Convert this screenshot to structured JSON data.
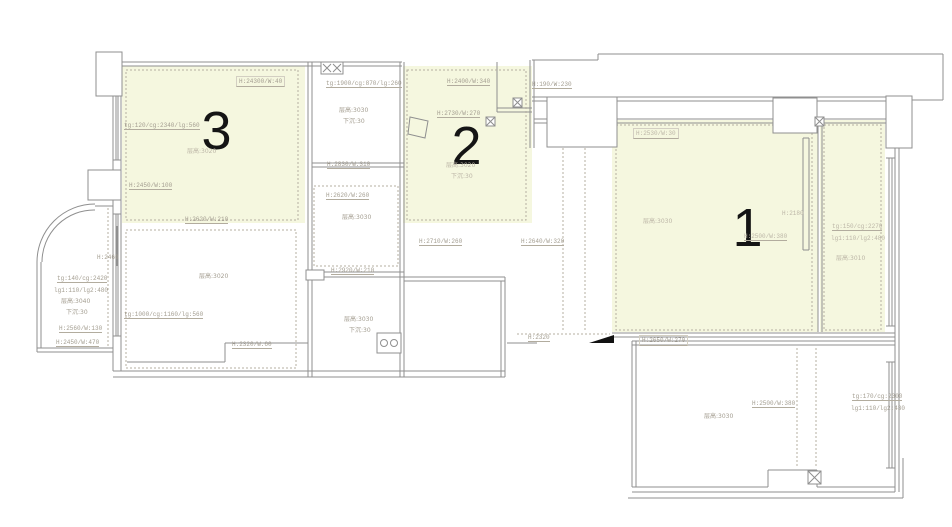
{
  "meta": {
    "type": "residential-floor-plan",
    "style": "cad-ceiling-plan"
  },
  "colors": {
    "highlight": "#f5f7df",
    "wall": "#8f8f8f",
    "annotation_text": "#a39d90",
    "room_digit": "#151515",
    "marker": "#111111"
  },
  "rooms": {
    "room1": {
      "digit": "1"
    },
    "room2": {
      "digit": "2"
    },
    "room3": {
      "digit": "3"
    }
  },
  "annotations": [
    {
      "text": "H:24300/W:40"
    },
    {
      "text": "tg:120/cg:2340/lg:560"
    },
    {
      "text": "层高:3020"
    },
    {
      "text": "H:2450/W:100"
    },
    {
      "text": "H:2620/W:210"
    },
    {
      "text": "tg:1900/cg:870/lg:260"
    },
    {
      "text": "层高:3030"
    },
    {
      "text": "下沉:30"
    },
    {
      "text": "H:2830/W:310"
    },
    {
      "text": "H:2400/W:340"
    },
    {
      "text": "H:2730/W:270"
    },
    {
      "text": "层高:3020"
    },
    {
      "text": "下沉:30"
    },
    {
      "text": "H:190/W:230"
    },
    {
      "text": "H:2530/W:30"
    },
    {
      "text": "层高:3030"
    },
    {
      "text": "H:2180"
    },
    {
      "text": "H:2500/W:380"
    },
    {
      "text": "tg:150/cg:2270"
    },
    {
      "text": "lg1:110/lg2:480"
    },
    {
      "text": "层高:3010"
    },
    {
      "text": "H:2460"
    },
    {
      "text": "tg:140/cg:2420"
    },
    {
      "text": "lg1:110/lg2:480"
    },
    {
      "text": "层高:3040"
    },
    {
      "text": "下沉:30"
    },
    {
      "text": "H:2560/W:130"
    },
    {
      "text": "H:2450/W:470"
    },
    {
      "text": "层高:3020"
    },
    {
      "text": "tg:1000/cg:1160/lg:560"
    },
    {
      "text": "H:2320/W:60"
    },
    {
      "text": "H:2620/W:260"
    },
    {
      "text": "层高:3030"
    },
    {
      "text": "H:2920/W:210"
    },
    {
      "text": "层高:3030"
    },
    {
      "text": "下沉:30"
    },
    {
      "text": "H:2710/W:260"
    },
    {
      "text": "H:2640/W:320"
    },
    {
      "text": "H:2320"
    },
    {
      "text": "H:2650/W:270"
    },
    {
      "text": "H:2500/W:380"
    },
    {
      "text": "层高:3030"
    },
    {
      "text": "tg:170/cg:2300"
    },
    {
      "text": "lg1:110/lg2:430"
    }
  ]
}
